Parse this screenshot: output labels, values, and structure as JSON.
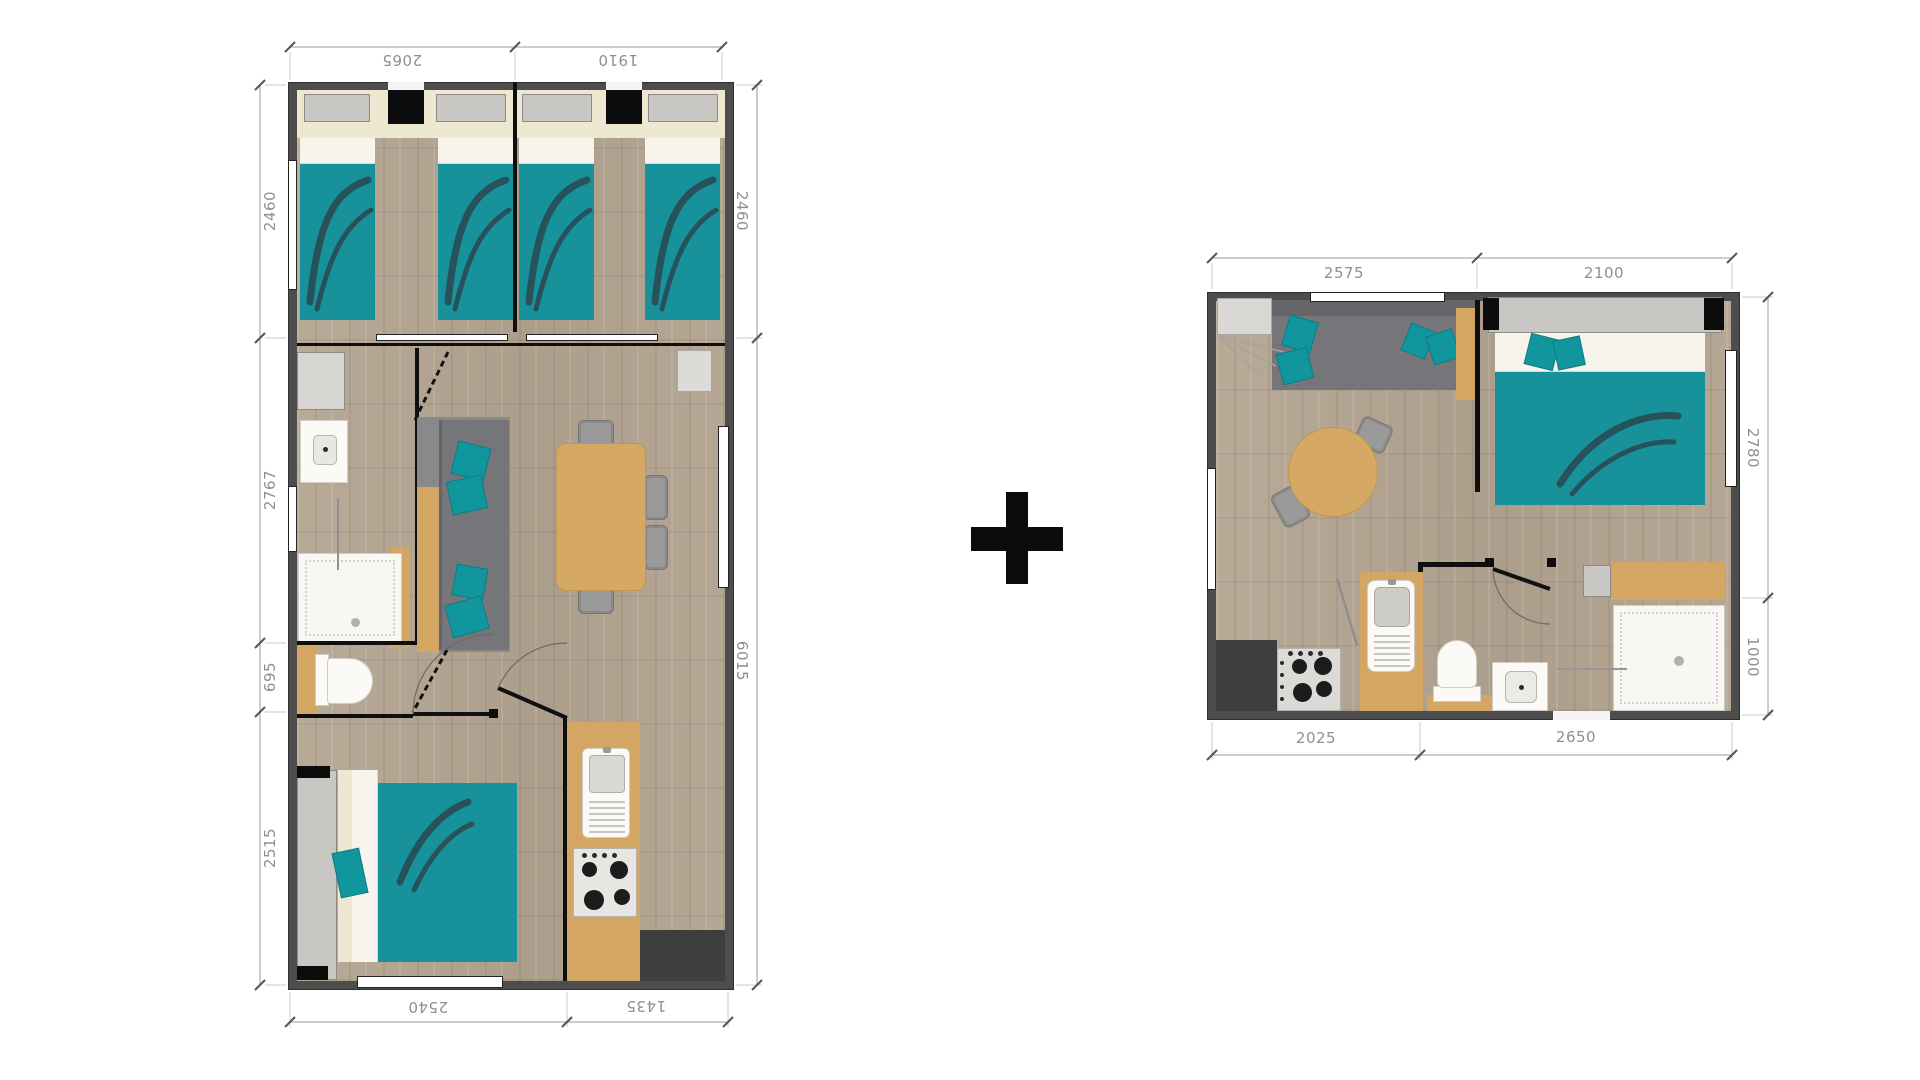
{
  "plans": {
    "left": {
      "title": "large-mobile-home-floor-plan",
      "dims": {
        "top": [
          "2065",
          "1910"
        ],
        "left": [
          "2460",
          "2767",
          "695",
          "2515"
        ],
        "right": [
          "2460",
          "6015"
        ],
        "bottom": [
          "2540",
          "1435"
        ]
      }
    },
    "right": {
      "title": "small-mobile-home-floor-plan",
      "dims": {
        "top": [
          "2575",
          "2100"
        ],
        "right": [
          "2780",
          "1000"
        ],
        "bottom": [
          "2025",
          "2650"
        ]
      }
    }
  },
  "separator": {
    "icon": "plus-icon"
  },
  "colors": {
    "teal": "#17929b",
    "wall": "#4d4d4d",
    "wood_furniture": "#d3a763",
    "floor": "#b3a592",
    "sofa_gray": "#76767a",
    "dim_text": "#8f8f8f",
    "feather": "#2b4a53"
  }
}
